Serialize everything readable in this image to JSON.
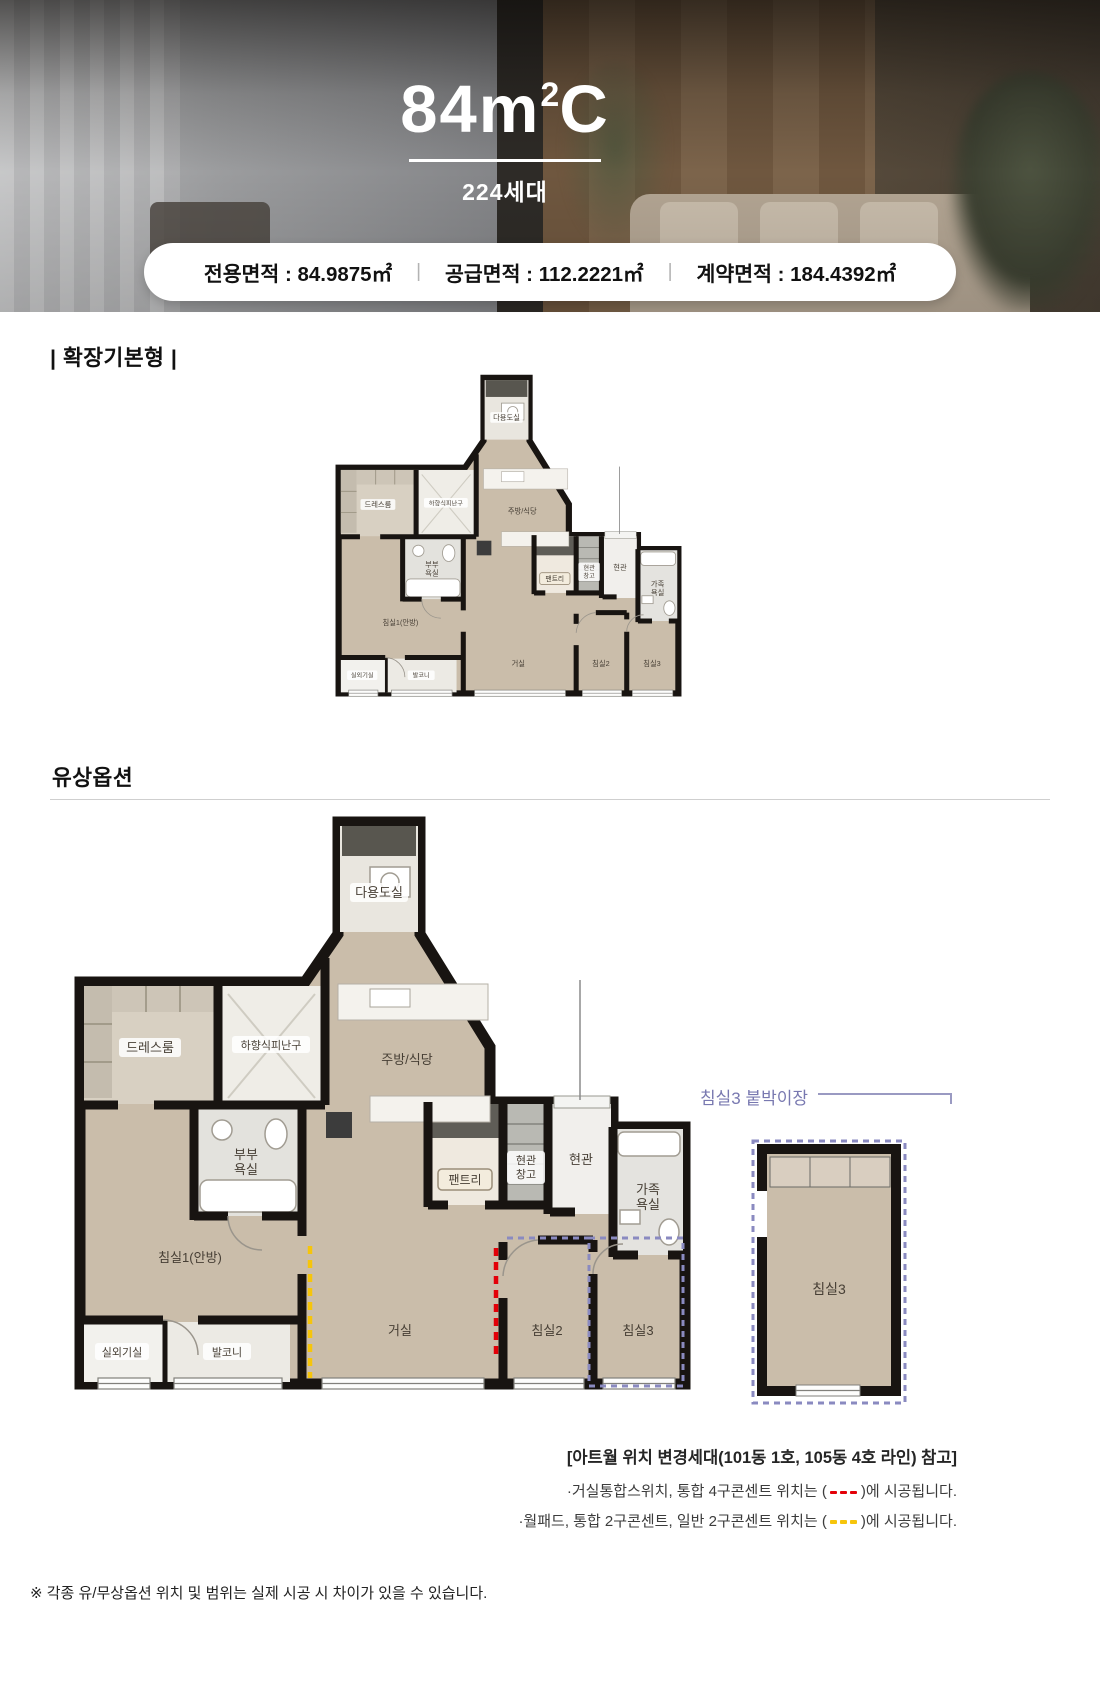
{
  "hero": {
    "title_main": "84m",
    "title_sup": "2",
    "title_suffix": "C",
    "units": "224세대",
    "area_items": [
      "전용면적 : 84.9875㎡",
      "공급면적 : 112.2221㎡",
      "계약면적 : 184.4392㎡"
    ],
    "divider": "|"
  },
  "sections": {
    "base_plan_title": "| 확장기본형 |",
    "paid_option_title": "유상옵션"
  },
  "floorplan": {
    "rooms": {
      "utility": "다용도실",
      "dress": "드레스룸",
      "escape": "하향식피난구",
      "kitchen": "주방/식당",
      "mbath1": "부부",
      "mbath2": "욕실",
      "pantry": "팬트리",
      "estor1": "현관",
      "estor2": "창고",
      "entry": "현관",
      "fbath1": "가족",
      "fbath2": "욕실",
      "bed1": "침실1(안방)",
      "living": "거실",
      "bed2": "침실2",
      "bed3": "침실3",
      "outdoor": "실외기실",
      "balcony": "발코니"
    }
  },
  "side_diagram": {
    "title": "침실3 붙박이장",
    "room": "침실3"
  },
  "notes": {
    "heading": "[아트월 위치 변경세대(101동 1호, 105동 4호 라인) 참고]",
    "line1_prefix": "·거실통합스위치, 통합 4구콘센트 위치는 (",
    "line1_suffix": ")에 시공됩니다.",
    "line2_prefix": "·월패드, 통합 2구콘센트, 일반 2구콘센트 위치는 (",
    "line2_suffix": ")에 시공됩니다."
  },
  "footer_note": "※ 각종 유/무상옵션 위치 및 범위는 실제 시공 시 차이가 있을 수 있습니다.",
  "colors": {
    "accent_red": "#e30008",
    "accent_yellow": "#f6c50b",
    "accent_purple": "#8a8ac0",
    "wall": "#181411",
    "floor": "#cabdaa"
  }
}
